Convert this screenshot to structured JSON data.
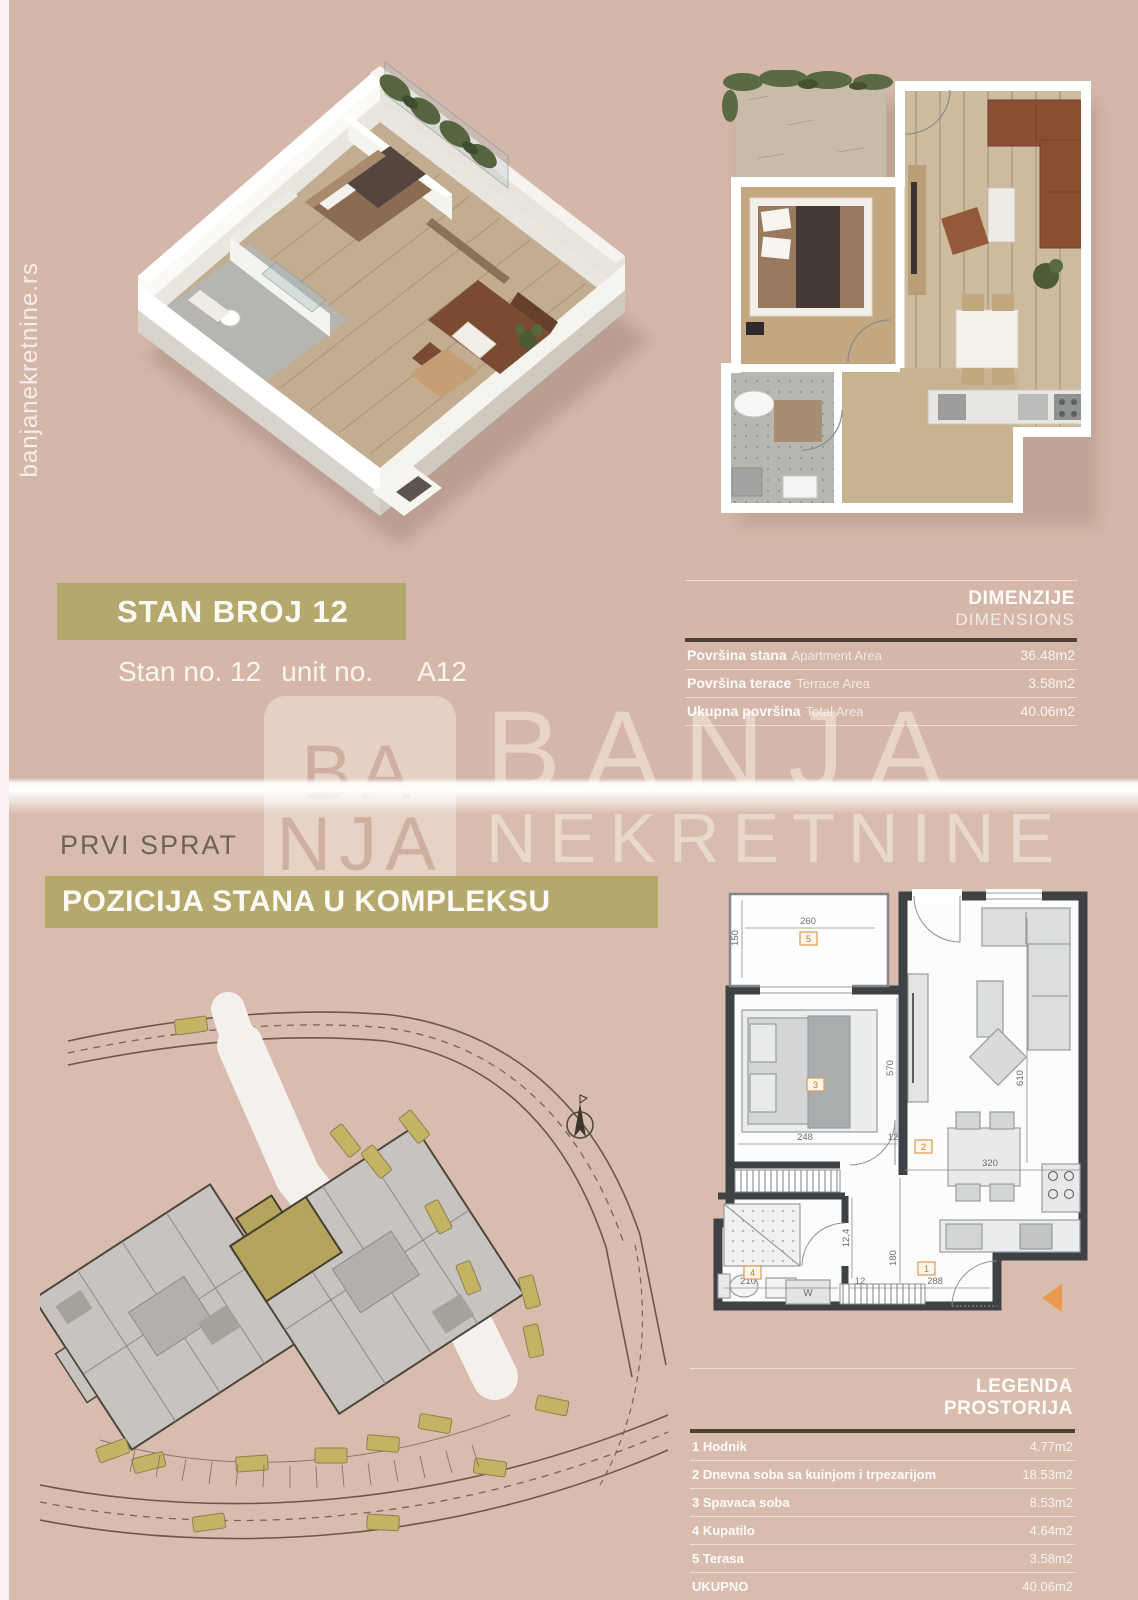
{
  "colors": {
    "background_top": "#d4b7a9",
    "background_bottom": "#d8bcae",
    "accent_olive": "#b4a86c",
    "table_rule_dark": "#4b4137",
    "text_white": "#fdfbf7",
    "muted_text": "#6e635a",
    "orange_marker": "#e89a4e",
    "site_highlight_unit": "#b5a45c"
  },
  "side": {
    "website_vertical": "banjanekretnine.rs"
  },
  "watermark": {
    "logo_line1": "BA",
    "logo_line2": "NJA",
    "brand_line1": "BANJA",
    "brand_line2": "NEKRETNINE"
  },
  "top_section": {
    "title": "STAN BROJ 12",
    "subtitle": {
      "stan_no": "Stan no. 12",
      "unit_no": "unit no.",
      "unit_code": "A12"
    },
    "dimensions_table": {
      "title": "DIMENZIJE",
      "subtitle": "DIMENSIONS",
      "rows": [
        {
          "label_sr": "Površina stana",
          "label_en": "Apartment Area",
          "value": "36.48m2"
        },
        {
          "label_sr": "Površina terace",
          "label_en": "Terrace Area",
          "value": "3.58m2"
        },
        {
          "label_sr": "Ukupna površina",
          "label_en": "Total Area",
          "value": "40.06m2"
        }
      ]
    }
  },
  "bottom_section": {
    "floor_label": "PRVI SPRAT",
    "position_title": "POZICIJA STANA U KOMPLEKSU",
    "legend_table": {
      "title_line1": "LEGENDA",
      "title_line2": "PROSTORIJA",
      "rows": [
        {
          "label": "1 Hodnik",
          "value": "4.77m2"
        },
        {
          "label": "2 Dnevna soba sa kuinjom i trpezarijom",
          "value": "18.53m2"
        },
        {
          "label": "3 Spavaca soba",
          "value": "8.53m2"
        },
        {
          "label": "4 Kupatilo",
          "value": "4.64m2"
        },
        {
          "label": "5 Terasa",
          "value": "3.58m2"
        },
        {
          "label": "UKUPNO",
          "value": "40.06m2"
        }
      ]
    },
    "floor_plan_2d": {
      "dims": {
        "terrace_width": "260",
        "terrace_depth": "150",
        "bedroom_width": "248",
        "wall_gap": "12",
        "living_width": "320",
        "living_height": "570",
        "right_height": "610",
        "bath_width": "210",
        "hall_width": "288",
        "hall_height": "180",
        "hall_gap": "12",
        "closet_depth": "12,4",
        "wardrobe": "W"
      },
      "rooms": {
        "hall": "1",
        "living": "2",
        "bedroom": "3",
        "bath": "4",
        "terrace": "5"
      }
    }
  }
}
